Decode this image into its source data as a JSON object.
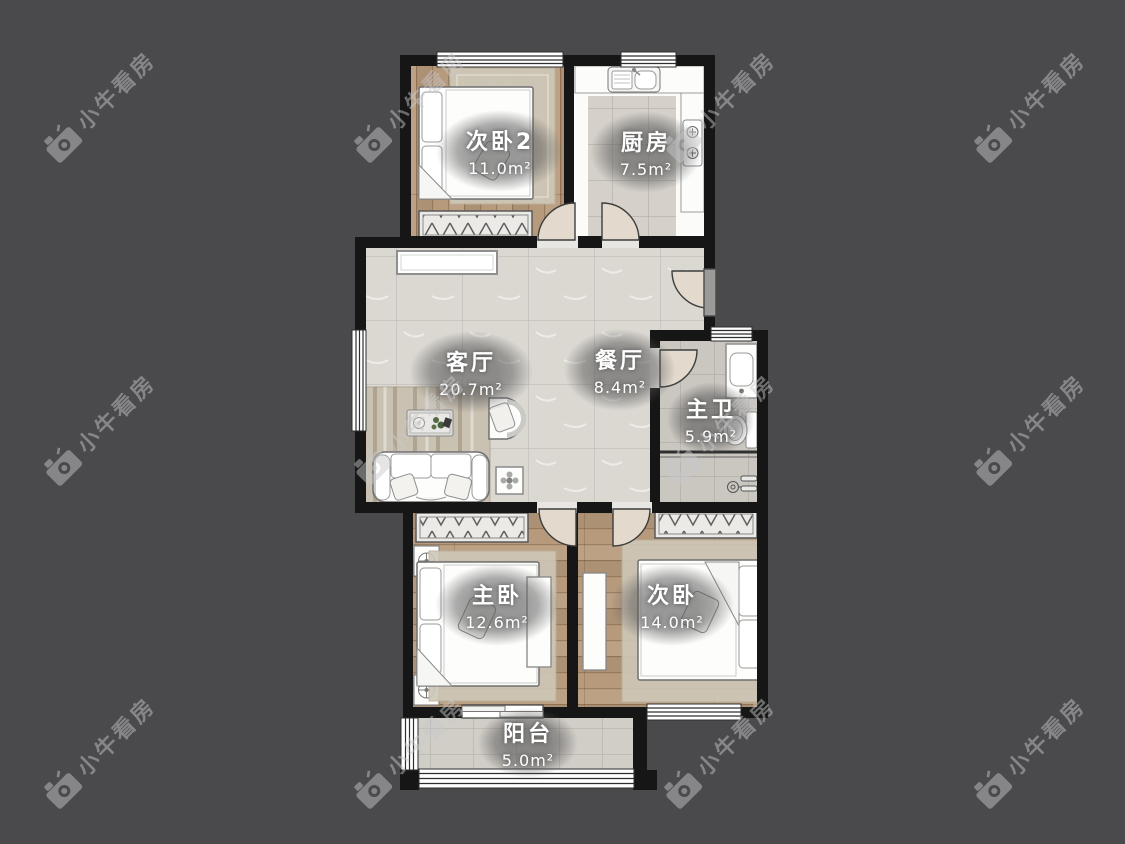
{
  "watermark": {
    "text": "小牛看房"
  },
  "colors": {
    "background": "#4a4a4c",
    "wall": "#161616",
    "wood_floor": "#b79a7c",
    "tile_floor": "#dbd8d2",
    "label_text": "#ffffff"
  },
  "rooms": [
    {
      "id": "bedroom2",
      "name": "次卧2",
      "area": "11.0m²"
    },
    {
      "id": "kitchen",
      "name": "厨房",
      "area": "7.5m²"
    },
    {
      "id": "living_room",
      "name": "客厅",
      "area": "20.7m²"
    },
    {
      "id": "dining_room",
      "name": "餐厅",
      "area": "8.4m²"
    },
    {
      "id": "master_bath",
      "name": "主卫",
      "area": "5.9m²"
    },
    {
      "id": "master_bedroom",
      "name": "主卧",
      "area": "12.6m²"
    },
    {
      "id": "bedroom",
      "name": "次卧",
      "area": "14.0m²"
    },
    {
      "id": "balcony",
      "name": "阳台",
      "area": "5.0m²"
    }
  ]
}
